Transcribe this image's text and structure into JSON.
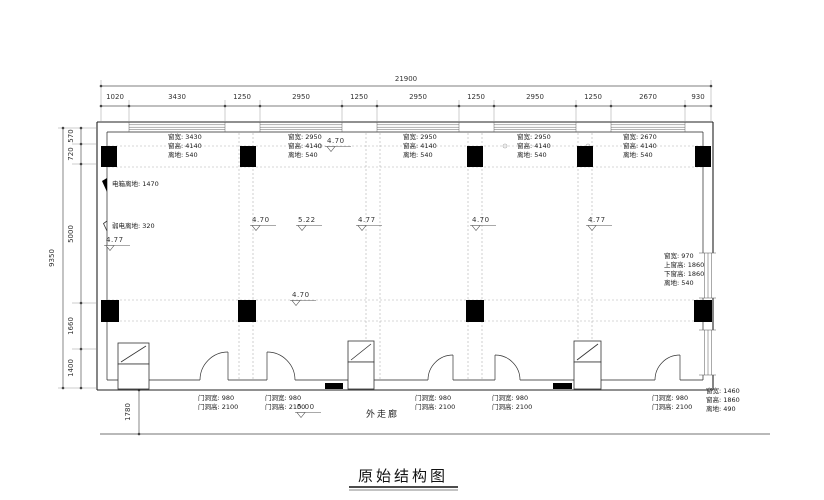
{
  "title": "原始结构图",
  "corridor_label": "外走廊",
  "dims": {
    "top_total": "21900",
    "top_segments": [
      "1020",
      "3430",
      "1250",
      "2950",
      "1250",
      "2950",
      "1250",
      "2950",
      "1250",
      "2670",
      "930"
    ],
    "left_total": "9350",
    "left_segments": [
      "570",
      "720",
      "5000",
      "1660",
      "1400"
    ],
    "corridor_width": "1780"
  },
  "windows": [
    {
      "lines": [
        "窗宽: 3430",
        "窗高: 4140",
        "离地: 540"
      ]
    },
    {
      "lines": [
        "窗宽: 2950",
        "窗高: 4140",
        "离地: 540"
      ]
    },
    {
      "lines": [
        "窗宽: 2950",
        "窗高: 4140",
        "离地: 540"
      ]
    },
    {
      "lines": [
        "窗宽: 2950",
        "窗高: 4140",
        "离地: 540"
      ]
    },
    {
      "lines": [
        "窗宽: 2670",
        "窗高: 4140",
        "离地: 540"
      ]
    }
  ],
  "right_window": {
    "lines": [
      "窗宽: 970",
      "上窗高: 1860",
      "下窗高: 1860",
      "离地: 540"
    ]
  },
  "bottom_right_window": {
    "lines": [
      "窗宽: 1460",
      "窗高: 1860",
      "离地: 490"
    ]
  },
  "doors": [
    {
      "lines": [
        "门洞宽: 980",
        "门洞高: 2100"
      ]
    },
    {
      "lines": [
        "门洞宽: 980",
        "门洞高: 2100"
      ]
    },
    {
      "lines": [
        "门洞宽: 980",
        "门洞高: 2100"
      ]
    },
    {
      "lines": [
        "门洞宽: 980",
        "门洞高: 2100"
      ]
    },
    {
      "lines": [
        "门洞宽: 980",
        "门洞高: 2100"
      ]
    }
  ],
  "wall_notes": [
    {
      "text": "电箱离地: 1470"
    },
    {
      "text": "弱电离地: 320"
    }
  ],
  "elevations": [
    {
      "value": "4.70"
    },
    {
      "value": "4.77"
    },
    {
      "value": "4.70"
    },
    {
      "value": "5.22"
    },
    {
      "value": "4.77"
    },
    {
      "value": "4.70"
    },
    {
      "value": "4.77"
    },
    {
      "value": "4.70"
    },
    {
      "value": "5.00"
    }
  ],
  "colors": {
    "line": "#222222",
    "dim": "#555555",
    "dashed": "#aaaaaa"
  }
}
